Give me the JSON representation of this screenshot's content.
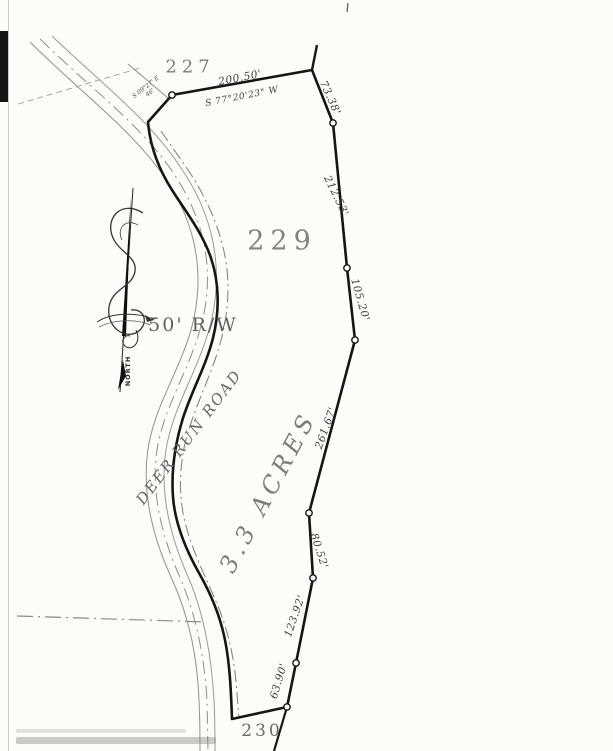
{
  "labels": {
    "lot_227": "227",
    "lot_229": "229",
    "lot_230": "230",
    "acreage": "3.3 ACRES",
    "road_name": "DEER RUN ROAD",
    "right_of_way": "50' R/W",
    "north": "NORTH"
  },
  "dimensions": {
    "top_distance": "200.50'",
    "top_bearing": "S 77°20'23\" W",
    "east_1": "73.38'",
    "east_2": "212.53'",
    "east_3": "105.20'",
    "east_4": "261.67'",
    "east_5": "80.52'",
    "east_6": "123.92'",
    "east_7": "63.90'",
    "small_bearing": "S 09°27' E",
    "small_distance": "46'"
  },
  "colors": {
    "boundary_line": "#151515",
    "thin_line": "#8f8f8f",
    "label_text": "#3c3c3c",
    "lot_text": "#828282",
    "background": "#fcfcfb"
  }
}
